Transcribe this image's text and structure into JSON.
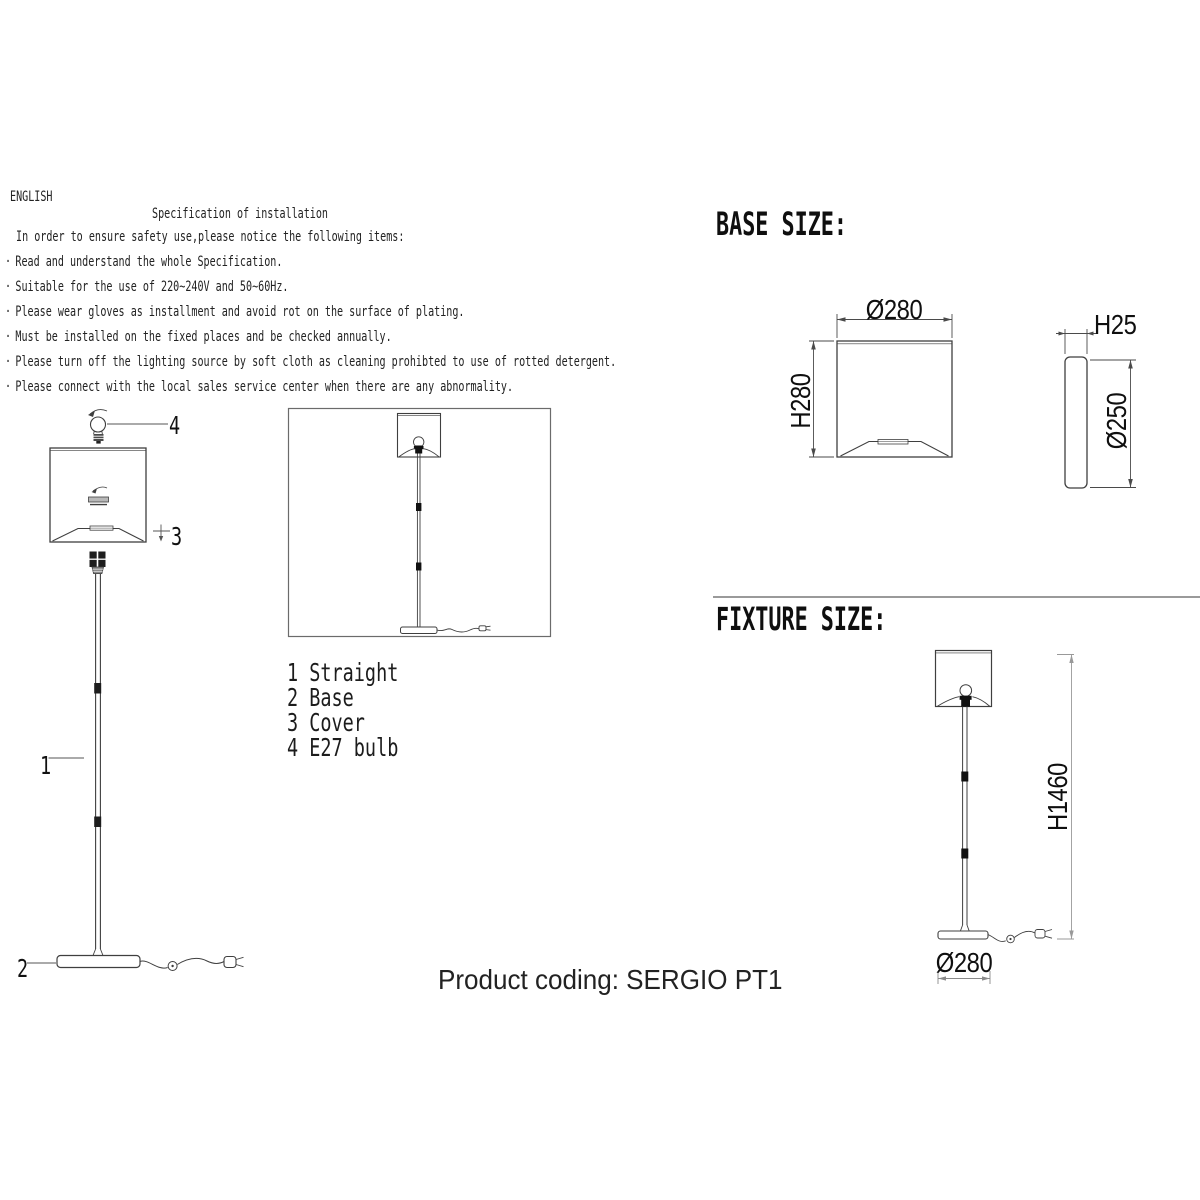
{
  "page": {
    "language": "ENGLISH",
    "product_coding": "Product coding: SERGIO PT1"
  },
  "spec": {
    "title": "Specification of installation",
    "intro": "In order to ensure safety use,please notice the following items:",
    "bullet_marker": "·",
    "bullets": [
      "Read and understand the whole Specification.",
      "Suitable for the use of 220~240V and 50~60Hz.",
      "Please wear gloves as installment and avoid rot on the surface of plating.",
      "Must be installed on the fixed places and be checked annually.",
      "Please turn off the lighting source by soft cloth as cleaning prohibted to use of rotted detergent.",
      "Please connect with the local sales service center when there are any abnormality."
    ]
  },
  "parts_list": {
    "items": [
      {
        "num": "1",
        "label": "Straight"
      },
      {
        "num": "2",
        "label": "Base"
      },
      {
        "num": "3",
        "label": "Cover"
      },
      {
        "num": "4",
        "label": "E27 bulb"
      }
    ]
  },
  "callouts": {
    "straight": "1",
    "base": "2",
    "cover": "3",
    "bulb": "4"
  },
  "base_size": {
    "heading": "BASE SIZE:",
    "shade_front": {
      "diameter": "Ø280",
      "height": "H280"
    },
    "base_side": {
      "thickness": "H25",
      "diameter": "Ø250"
    }
  },
  "fixture_size": {
    "heading": "FIXTURE SIZE:",
    "total_height": "H1460",
    "base_diameter": "Ø280"
  },
  "colors": {
    "line": "#3f3f3f",
    "dimension_line": "#4a4a4a",
    "light_dimension_line": "#999999",
    "divider": "#9a9a9a"
  }
}
